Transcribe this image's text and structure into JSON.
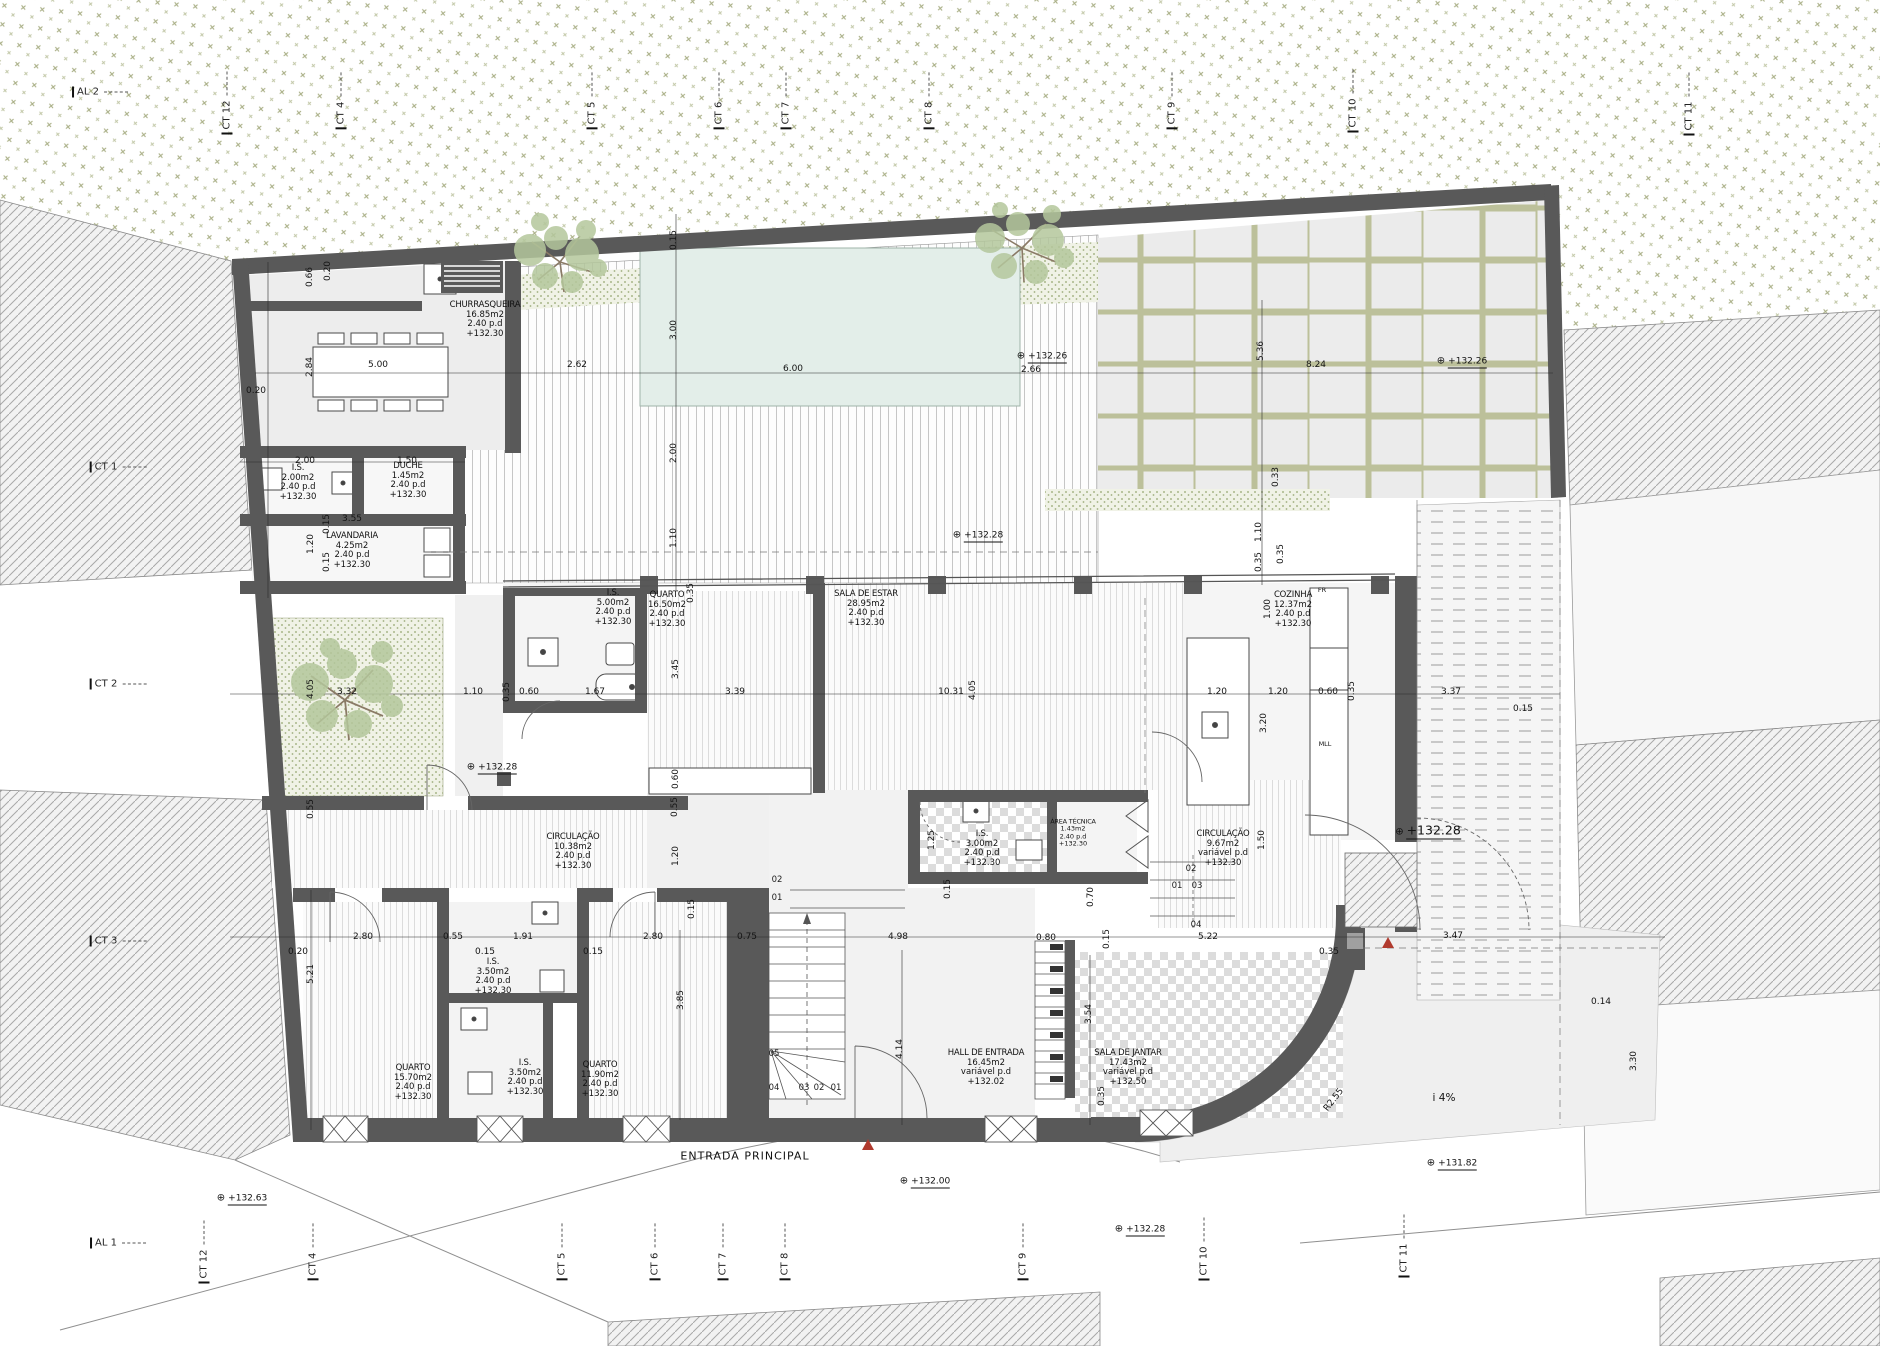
{
  "page": {
    "width": 1880,
    "height": 1346,
    "kind": "architectural floor plan"
  },
  "colors": {
    "wall": "#595959",
    "pool": "#e3eee9",
    "vegetation": "#979b6d",
    "bed": "#a9b78a",
    "accent_red": "#b03a2e",
    "paper": "#ffffff"
  },
  "rooms": [
    {
      "name": "CHURRASQUEIRA",
      "area": "16.85m2",
      "pd": "2.40 p.d",
      "lvl": "+132.30",
      "x": 485,
      "y": 320
    },
    {
      "name": "I.S.",
      "area": "2.00m2",
      "pd": "2.40 p.d",
      "lvl": "+132.30",
      "x": 298,
      "y": 483
    },
    {
      "name": "DUCHE",
      "area": "1.45m2",
      "pd": "2.40 p.d",
      "lvl": "+132.30",
      "x": 408,
      "y": 481
    },
    {
      "name": "LAVANDARIA",
      "area": "4.25m2",
      "pd": "2.40 p.d",
      "lvl": "+132.30",
      "x": 352,
      "y": 551
    },
    {
      "name": "I.S.",
      "area": "5.00m2",
      "pd": "2.40 p.d",
      "lvl": "+132.30",
      "x": 613,
      "y": 608
    },
    {
      "name": "QUARTO",
      "area": "16.50m2",
      "pd": "2.40 p.d",
      "lvl": "+132.30",
      "x": 667,
      "y": 610
    },
    {
      "name": "SALA DE ESTAR",
      "area": "28.95m2",
      "pd": "2.40 p.d",
      "lvl": "+132.30",
      "x": 866,
      "y": 609
    },
    {
      "name": "COZINHA",
      "area": "12.37m2",
      "pd": "2.40 p.d",
      "lvl": "+132.30",
      "x": 1293,
      "y": 610
    },
    {
      "name": "CIRCULAÇÃO",
      "area": "10.38m2",
      "pd": "2.40 p.d",
      "lvl": "+132.30",
      "x": 573,
      "y": 852
    },
    {
      "name": "I.S.",
      "area": "3.00m2",
      "pd": "2.40 p.d",
      "lvl": "+132.30",
      "x": 982,
      "y": 849
    },
    {
      "name": "ÁREA TÉCNICA",
      "area": "1.43m2",
      "pd": "2.40 p.d",
      "lvl": "+132.30",
      "x": 1073,
      "y": 833,
      "small": 1
    },
    {
      "name": "CIRCULAÇÃO",
      "area": "9.67m2",
      "pd": "variável p.d",
      "lvl": "+132.30",
      "x": 1223,
      "y": 849
    },
    {
      "name": "QUARTO",
      "area": "15.70m2",
      "pd": "2.40 p.d",
      "lvl": "+132.30",
      "x": 413,
      "y": 1083
    },
    {
      "name": "I.S.",
      "area": "3.50m2",
      "pd": "2.40 p.d",
      "lvl": "+132.30",
      "x": 493,
      "y": 977
    },
    {
      "name": "I.S.",
      "area": "3.50m2",
      "pd": "2.40 p.d",
      "lvl": "+132.30",
      "x": 525,
      "y": 1078
    },
    {
      "name": "QUARTO",
      "area": "11.90m2",
      "pd": "2.40 p.d",
      "lvl": "+132.30",
      "x": 600,
      "y": 1080
    },
    {
      "name": "HALL DE ENTRADA",
      "area": "16.45m2",
      "pd": "variável p.d",
      "lvl": "+132.02",
      "x": 986,
      "y": 1068
    },
    {
      "name": "SALA DE JANTAR",
      "area": "17.43m2",
      "pd": "variável p.d",
      "lvl": "+132.50",
      "x": 1128,
      "y": 1068
    }
  ],
  "dimensions": [
    {
      "t": "0.20",
      "x": 256,
      "y": 391
    },
    {
      "t": "0.66",
      "x": 310,
      "y": 277,
      "v": 1
    },
    {
      "t": "0.20",
      "x": 328,
      "y": 271,
      "v": 1
    },
    {
      "t": "2.84",
      "x": 310,
      "y": 367,
      "v": 1
    },
    {
      "t": "5.00",
      "x": 378,
      "y": 365
    },
    {
      "t": "2.62",
      "x": 577,
      "y": 365
    },
    {
      "t": "6.00",
      "x": 793,
      "y": 369
    },
    {
      "t": "2.66",
      "x": 1031,
      "y": 370
    },
    {
      "t": "8.24",
      "x": 1316,
      "y": 365
    },
    {
      "t": "0.15",
      "x": 674,
      "y": 240,
      "v": 1
    },
    {
      "t": "3.00",
      "x": 674,
      "y": 330,
      "v": 1
    },
    {
      "t": "2.00",
      "x": 674,
      "y": 453,
      "v": 1
    },
    {
      "t": "1.10",
      "x": 674,
      "y": 538,
      "v": 1
    },
    {
      "t": "5.36",
      "x": 1261,
      "y": 351,
      "v": 1
    },
    {
      "t": "0.33",
      "x": 1276,
      "y": 477,
      "v": 1
    },
    {
      "t": "1.10",
      "x": 1259,
      "y": 532,
      "v": 1
    },
    {
      "t": "0.35",
      "x": 1259,
      "y": 562,
      "v": 1
    },
    {
      "t": "2.00",
      "x": 305,
      "y": 461
    },
    {
      "t": "1.50",
      "x": 407,
      "y": 461
    },
    {
      "t": "3.55",
      "x": 352,
      "y": 519
    },
    {
      "t": "0.15",
      "x": 327,
      "y": 524,
      "v": 1
    },
    {
      "t": "1.20",
      "x": 311,
      "y": 544,
      "v": 1
    },
    {
      "t": "0.15",
      "x": 327,
      "y": 562,
      "v": 1
    },
    {
      "t": "3.32",
      "x": 347,
      "y": 692
    },
    {
      "t": "4.05",
      "x": 311,
      "y": 689,
      "v": 1
    },
    {
      "t": "1.10",
      "x": 473,
      "y": 692
    },
    {
      "t": "0.35",
      "x": 507,
      "y": 692,
      "v": 1
    },
    {
      "t": "0.60",
      "x": 529,
      "y": 692
    },
    {
      "t": "1.67",
      "x": 595,
      "y": 692
    },
    {
      "t": "3.39",
      "x": 735,
      "y": 692
    },
    {
      "t": "3.45",
      "x": 676,
      "y": 669,
      "v": 1
    },
    {
      "t": "0.35",
      "x": 691,
      "y": 593,
      "v": 1
    },
    {
      "t": "0.60",
      "x": 676,
      "y": 779,
      "v": 1
    },
    {
      "t": "10.31",
      "x": 951,
      "y": 692
    },
    {
      "t": "4.05",
      "x": 973,
      "y": 690,
      "v": 1
    },
    {
      "t": "1.20",
      "x": 1217,
      "y": 692
    },
    {
      "t": "1.20",
      "x": 1278,
      "y": 692
    },
    {
      "t": "0.60",
      "x": 1328,
      "y": 692
    },
    {
      "t": "0.35",
      "x": 1352,
      "y": 691,
      "v": 1
    },
    {
      "t": "3.37",
      "x": 1451,
      "y": 692
    },
    {
      "t": "0.15",
      "x": 1523,
      "y": 709
    },
    {
      "t": "1.00",
      "x": 1268,
      "y": 609,
      "v": 1
    },
    {
      "t": "3.20",
      "x": 1264,
      "y": 723,
      "v": 1
    },
    {
      "t": "0.35",
      "x": 1281,
      "y": 554,
      "v": 1
    },
    {
      "t": "0.55",
      "x": 311,
      "y": 809,
      "v": 1
    },
    {
      "t": "0.55",
      "x": 675,
      "y": 807,
      "v": 1
    },
    {
      "t": "1.20",
      "x": 676,
      "y": 856,
      "v": 1
    },
    {
      "t": "0.15",
      "x": 692,
      "y": 909,
      "v": 1
    },
    {
      "t": "0.20",
      "x": 298,
      "y": 952
    },
    {
      "t": "2.80",
      "x": 363,
      "y": 937
    },
    {
      "t": "0.55",
      "x": 453,
      "y": 937
    },
    {
      "t": "1.91",
      "x": 523,
      "y": 937
    },
    {
      "t": "0.15",
      "x": 485,
      "y": 952
    },
    {
      "t": "0.15",
      "x": 593,
      "y": 952
    },
    {
      "t": "2.80",
      "x": 653,
      "y": 937
    },
    {
      "t": "0.75",
      "x": 747,
      "y": 937
    },
    {
      "t": "4.98",
      "x": 898,
      "y": 937
    },
    {
      "t": "0.80",
      "x": 1046,
      "y": 938
    },
    {
      "t": "5.22",
      "x": 1208,
      "y": 937
    },
    {
      "t": "3.47",
      "x": 1453,
      "y": 936
    },
    {
      "t": "0.35",
      "x": 1329,
      "y": 952
    },
    {
      "t": "0.14",
      "x": 1601,
      "y": 1002
    },
    {
      "t": "5.21",
      "x": 311,
      "y": 974,
      "v": 1
    },
    {
      "t": "3.85",
      "x": 681,
      "y": 1000,
      "v": 1
    },
    {
      "t": "4.14",
      "x": 900,
      "y": 1049,
      "v": 1
    },
    {
      "t": "3.54",
      "x": 1089,
      "y": 1014,
      "v": 1
    },
    {
      "t": "0.35",
      "x": 1102,
      "y": 1096,
      "v": 1
    },
    {
      "t": "0.70",
      "x": 1091,
      "y": 897,
      "v": 1
    },
    {
      "t": "0.15",
      "x": 948,
      "y": 889,
      "v": 1
    },
    {
      "t": "1.25",
      "x": 932,
      "y": 840,
      "v": 1
    },
    {
      "t": "1.50",
      "x": 1262,
      "y": 840,
      "v": 1
    },
    {
      "t": "0.15",
      "x": 1107,
      "y": 939,
      "v": 1
    },
    {
      "t": "3.30",
      "x": 1634,
      "y": 1061,
      "v": 1
    }
  ],
  "levels": [
    {
      "t": "+132.26",
      "x": 1042,
      "y": 356
    },
    {
      "t": "+132.26",
      "x": 1462,
      "y": 361
    },
    {
      "t": "+132.28",
      "x": 978,
      "y": 535
    },
    {
      "t": "+132.28",
      "x": 492,
      "y": 767
    },
    {
      "t": "+132.28",
      "x": 1428,
      "y": 830,
      "big": 1
    },
    {
      "t": "+132.00",
      "x": 925,
      "y": 1181
    },
    {
      "t": "+132.63",
      "x": 242,
      "y": 1198
    },
    {
      "t": "+132.28",
      "x": 1140,
      "y": 1229
    },
    {
      "t": "+131.82",
      "x": 1452,
      "y": 1163
    }
  ],
  "grid_labels": [
    {
      "t": "AL 2",
      "x": 100,
      "y": 92
    },
    {
      "t": "CT 12",
      "x": 227,
      "y": 103,
      "v": 1
    },
    {
      "t": "CT 4",
      "x": 341,
      "y": 101,
      "v": 1
    },
    {
      "t": "CT 5",
      "x": 592,
      "y": 101,
      "v": 1
    },
    {
      "t": "CT 6",
      "x": 719,
      "y": 101,
      "v": 1
    },
    {
      "t": "CT 7",
      "x": 786,
      "y": 101,
      "v": 1
    },
    {
      "t": "CT 8",
      "x": 929,
      "y": 101,
      "v": 1
    },
    {
      "t": "CT 9",
      "x": 1172,
      "y": 101,
      "v": 1
    },
    {
      "t": "CT 10",
      "x": 1353,
      "y": 101,
      "v": 1
    },
    {
      "t": "CT 11",
      "x": 1689,
      "y": 104,
      "v": 1
    },
    {
      "t": "CT 1",
      "x": 118,
      "y": 467
    },
    {
      "t": "CT 2",
      "x": 118,
      "y": 684
    },
    {
      "t": "CT 3",
      "x": 118,
      "y": 941
    },
    {
      "t": "AL 1",
      "x": 118,
      "y": 1243
    },
    {
      "t": "CT 12",
      "x": 204,
      "y": 1252,
      "v": 1
    },
    {
      "t": "CT 4",
      "x": 313,
      "y": 1252,
      "v": 1
    },
    {
      "t": "CT 5",
      "x": 562,
      "y": 1252,
      "v": 1
    },
    {
      "t": "CT 6",
      "x": 655,
      "y": 1252,
      "v": 1
    },
    {
      "t": "CT 7",
      "x": 723,
      "y": 1252,
      "v": 1
    },
    {
      "t": "CT 8",
      "x": 785,
      "y": 1252,
      "v": 1
    },
    {
      "t": "CT 9",
      "x": 1023,
      "y": 1252,
      "v": 1
    },
    {
      "t": "CT 10",
      "x": 1204,
      "y": 1249,
      "v": 1
    },
    {
      "t": "CT 11",
      "x": 1404,
      "y": 1246,
      "v": 1
    }
  ],
  "step_numbers": [
    {
      "t": "02",
      "x": 777,
      "y": 880
    },
    {
      "t": "01",
      "x": 777,
      "y": 898
    },
    {
      "t": "05",
      "x": 774,
      "y": 1054
    },
    {
      "t": "04",
      "x": 774,
      "y": 1088
    },
    {
      "t": "03",
      "x": 804,
      "y": 1088
    },
    {
      "t": "02",
      "x": 819,
      "y": 1088
    },
    {
      "t": "01",
      "x": 836,
      "y": 1088
    },
    {
      "t": "02",
      "x": 1191,
      "y": 869
    },
    {
      "t": "01",
      "x": 1177,
      "y": 886
    },
    {
      "t": "03",
      "x": 1197,
      "y": 886
    },
    {
      "t": "04",
      "x": 1196,
      "y": 925
    }
  ],
  "annotations": [
    {
      "t": "ENTRADA PRINCIPAL",
      "x": 745,
      "y": 1156,
      "fs": 11,
      "ls": 1
    },
    {
      "t": "i 4%",
      "x": 1444,
      "y": 1098,
      "fs": 10.5
    },
    {
      "t": "R2.55",
      "x": 1334,
      "y": 1100,
      "fs": 9,
      "rot": -52
    },
    {
      "t": "FR",
      "x": 1322,
      "y": 590,
      "fs": 6.5
    },
    {
      "t": "MLL",
      "x": 1325,
      "y": 744,
      "fs": 6.5
    }
  ]
}
